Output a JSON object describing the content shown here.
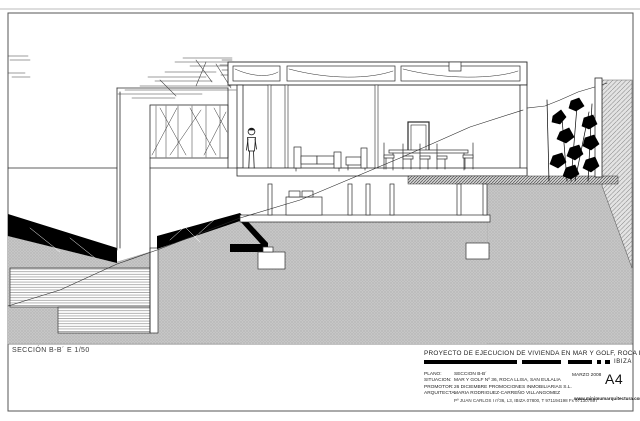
{
  "sheet": {
    "caption": "SECCIÓN B-B´ E 1/50",
    "title_block": {
      "project_title": "PROYECTO DE EJECUCION DE VIVIENDA EN MAR Y GOLF, ROCA LLISA",
      "location": "IBIZA",
      "fields": [
        {
          "label": "PLANO:",
          "value": "SECCION  B-B´"
        },
        {
          "label": "SITUACION:",
          "value": "MAR Y GOLF Nº 36,  ROCA LLISA, SAN EULALIA"
        },
        {
          "label": "PROMOTOR:",
          "value": "26  DICIEMBRE PROMOCIONES INMOBILIARIAS S.L."
        },
        {
          "label": "ARQUITECTA:",
          "value": "MARIA RODRIGUEZ-CARREÑO VILLANGOMEZ"
        }
      ],
      "address": "Pº JUAN CARLOS I nº36, L3, IBIZA 07800, T 971194198  Fx 971307897",
      "date": "MARZO 2008",
      "sheet_size": "A4",
      "website": "www.minimumarquitectura.com"
    },
    "colors": {
      "ink": "#1a1a1a",
      "ground_gray": "#c4c4c4",
      "hatch_gray": "#8f8f8f"
    }
  }
}
